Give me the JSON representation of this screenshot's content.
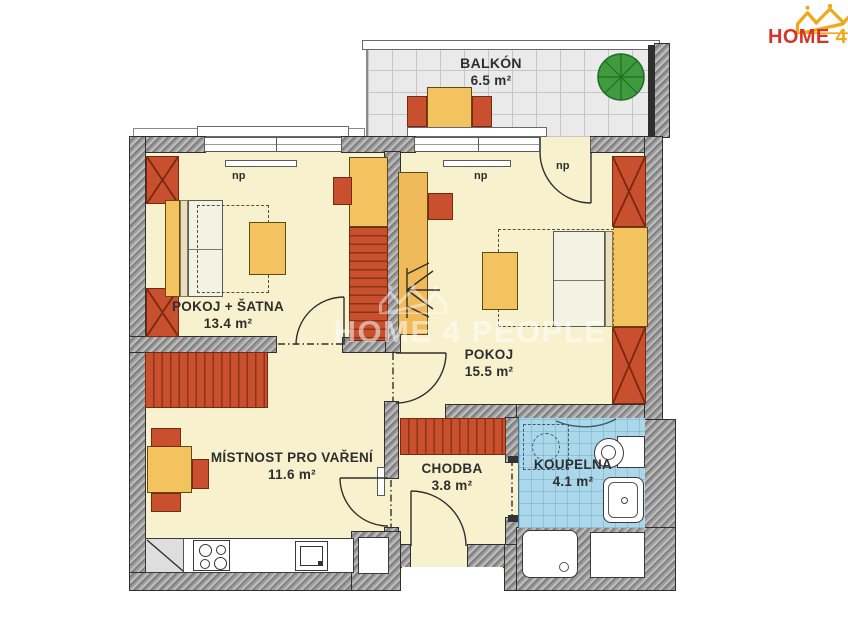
{
  "brand": {
    "word1": "HOME",
    "word2": "4",
    "word3": "PEOPLE"
  },
  "watermark": {
    "line": "HOME 4 PEOPLE"
  },
  "rooms": {
    "balkon": {
      "name": "BALKÓN",
      "area": "6.5 m²"
    },
    "pokoj_satna": {
      "name": "POKOJ + ŠATNA",
      "area": "13.4 m²"
    },
    "pokoj": {
      "name": "POKOJ",
      "area": "15.5 m²"
    },
    "varna": {
      "name": "MÍSTNOST PRO VAŘENÍ",
      "area": "11.6 m²"
    },
    "chodba": {
      "name": "CHODBA",
      "area": "3.8 m²"
    },
    "koupelna": {
      "name": "KOUPELNA",
      "area": "4.1 m²"
    }
  },
  "annotations": {
    "np": "np"
  },
  "colors": {
    "floor": "#F8F1CD",
    "bath_floor": "#ABD7EA",
    "furniture_yellow": "#F2C35E",
    "furniture_red": "#C8502E",
    "wall_gray": "#8A8A8A",
    "brand_red": "#D8332A",
    "brand_yellow": "#F0A81C",
    "plant_green": "#3E9B3E"
  }
}
